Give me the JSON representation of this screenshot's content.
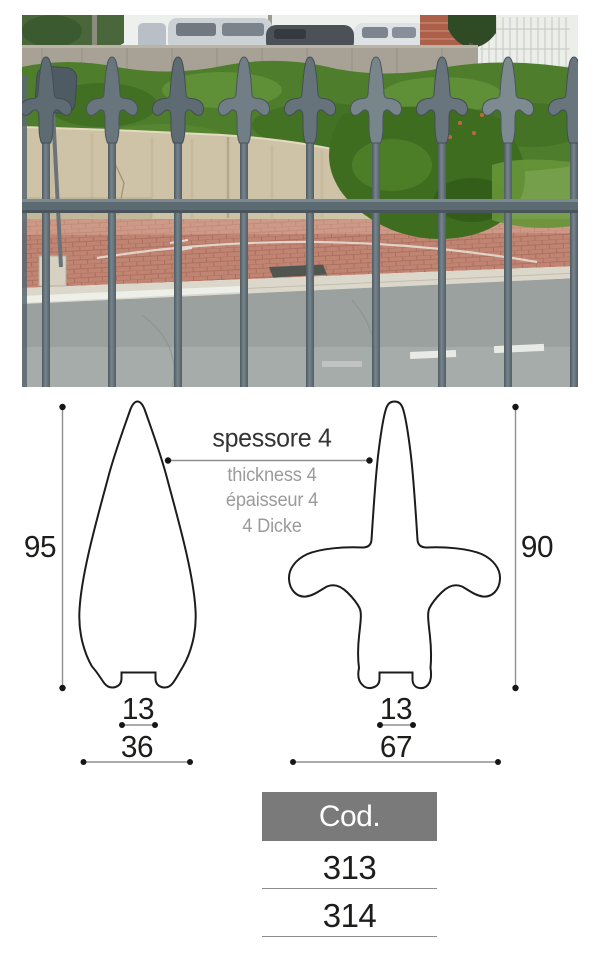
{
  "page": {
    "background": "#ffffff"
  },
  "photo": {
    "subject": "galvanized metal fence with fleur-de-lis spear point finials in front of a hedge, paved court and road"
  },
  "diagram": {
    "thickness_label": "spessore 4",
    "thickness_translations": [
      "thickness 4",
      "épaisseur 4",
      "4 Dicke"
    ],
    "left_profile": {
      "name": "spear-point-profile",
      "height": "95",
      "base_slot_width": "13",
      "max_width": "36"
    },
    "right_profile": {
      "name": "fleur-de-lis-profile",
      "height": "90",
      "base_slot_width": "13",
      "max_width": "67"
    }
  },
  "codes": {
    "header": "Cod.",
    "rows": [
      "313",
      "314"
    ]
  },
  "colors": {
    "outline": "#1c1c1c",
    "dimension_line": "#8f8f8f",
    "dimension_text": "#1d1d1b",
    "translation_text": "#9b9b9b",
    "table_header_bg": "#7a7a7a",
    "table_header_text": "#ffffff",
    "table_line": "#8c8c8c",
    "fence_metal": "#5e6b72",
    "hedge_green": "#4e7e2c",
    "wall_beige": "#cfc3a7",
    "pavement_pink": "#c08472",
    "road_gray": "#9ba19e"
  }
}
